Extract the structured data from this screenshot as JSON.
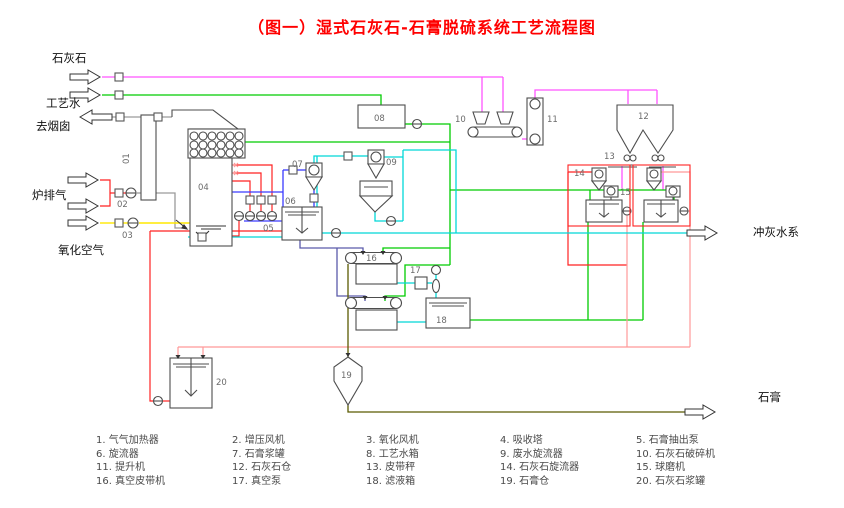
{
  "title": "（图一）湿式石灰石-石膏脱硫系统工艺流程图",
  "io": {
    "limestone": "石灰石",
    "process_water": "工艺水",
    "to_stack": "去烟囱",
    "boiler_gas": "炉排气",
    "oxidation_air": "氧化空气",
    "ash_flush_water": "冲灰水系",
    "gypsum": "石膏"
  },
  "tags": {
    "t01": "01",
    "t02": "02",
    "t03": "03",
    "t04": "04",
    "t05": "05",
    "t06": "06",
    "t07": "07",
    "t08": "08",
    "t09": "09",
    "t10": "10",
    "t11": "11",
    "t12": "12",
    "t13": "13",
    "t14": "14",
    "t15": "15",
    "t16": "16",
    "t17": "17",
    "t18": "18",
    "t19": "19",
    "t20": "20"
  },
  "legend": [
    "1. 气气加热器",
    "2. 增压风机",
    "3. 氧化风机",
    "4. 吸收塔",
    "5. 石膏抽出泵",
    "6. 旋流器",
    "7. 石膏浆罐",
    "8. 工艺水箱",
    "9. 废水旋流器",
    "10. 石灰石破碎机",
    "11. 提升机",
    "12. 石灰石仓",
    "13. 皮带秤",
    "14. 石灰石旋流器",
    "15. 球磨机",
    "16. 真空皮带机",
    "17. 真空泵",
    "18. 滤液箱",
    "19. 石膏仓",
    "20. 石灰石浆罐"
  ],
  "colors": {
    "title": "#ff0000",
    "flue_gas": "#9a9a9a",
    "limestone": "#ff55ff",
    "process_water": "#00cc00",
    "slurry_red": "#ff2222",
    "limestone_slurry": "#ff9999",
    "oxidation_air": "#ffe800",
    "filtrate_water": "#00d8d8",
    "gypsum_slurry": "#3a3aff",
    "slurry_feed": "#5a5aaa",
    "gypsum_solid": "#5a5a00",
    "equipment_outline": "#4d4d4d"
  }
}
